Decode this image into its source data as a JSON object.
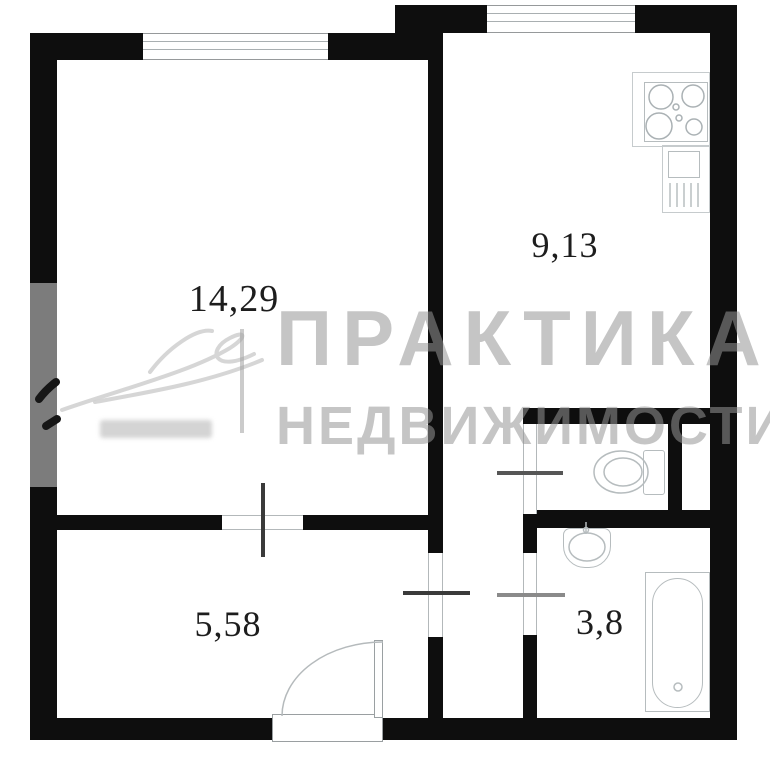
{
  "floor_plan": {
    "type": "apartment-floor-plan",
    "rooms": [
      {
        "name": "living-room",
        "area": "14,29"
      },
      {
        "name": "kitchen",
        "area": "9,13"
      },
      {
        "name": "hallway",
        "area": "5,58"
      },
      {
        "name": "bathroom",
        "area": "3,8"
      }
    ],
    "fixtures": [
      "stove",
      "kitchen-sink",
      "toilet",
      "wash-basin",
      "bathtub"
    ],
    "watermark": {
      "line1": "ПРАКТИКА",
      "line2": "НЕДВИЖИМОСТИ"
    },
    "colors": {
      "wall": "#0e0e0e",
      "window_wall_segment": "#7c7c7c",
      "fixture_outline": "#b6bcbe",
      "label_text": "#1d1d1d",
      "watermark_gray": "rgba(150,150,150,0.55)"
    }
  }
}
